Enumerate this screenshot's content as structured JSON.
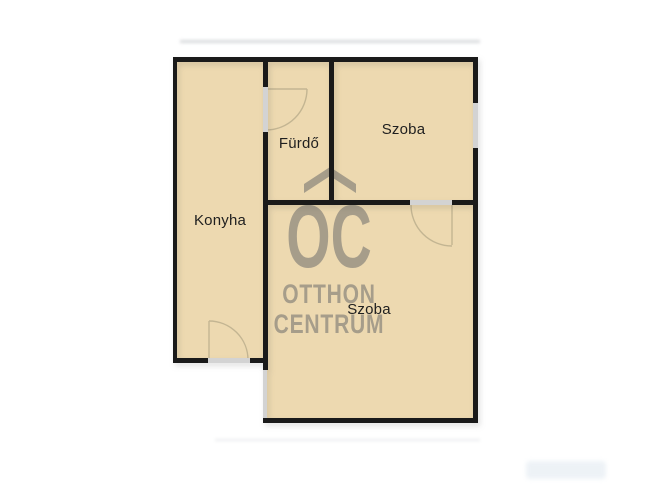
{
  "plan": {
    "rooms": [
      {
        "id": "konyha",
        "label": "Konyha"
      },
      {
        "id": "furdo",
        "label": "Fürdő"
      },
      {
        "id": "szoba-top",
        "label": "Szoba"
      },
      {
        "id": "szoba-bottom",
        "label": "Szoba"
      }
    ]
  },
  "watermark": {
    "monogram": "OC",
    "line1": "OTTHON",
    "line2": "CENTRUM"
  },
  "colors": {
    "background": "#ffffff",
    "room_fill": "#edd9b0",
    "wall": "#1a1a1a",
    "opening": "#d3d3d3",
    "door_arc": "#c3b592",
    "label_text": "#1f1f1f",
    "watermark": "#a69d8a"
  }
}
